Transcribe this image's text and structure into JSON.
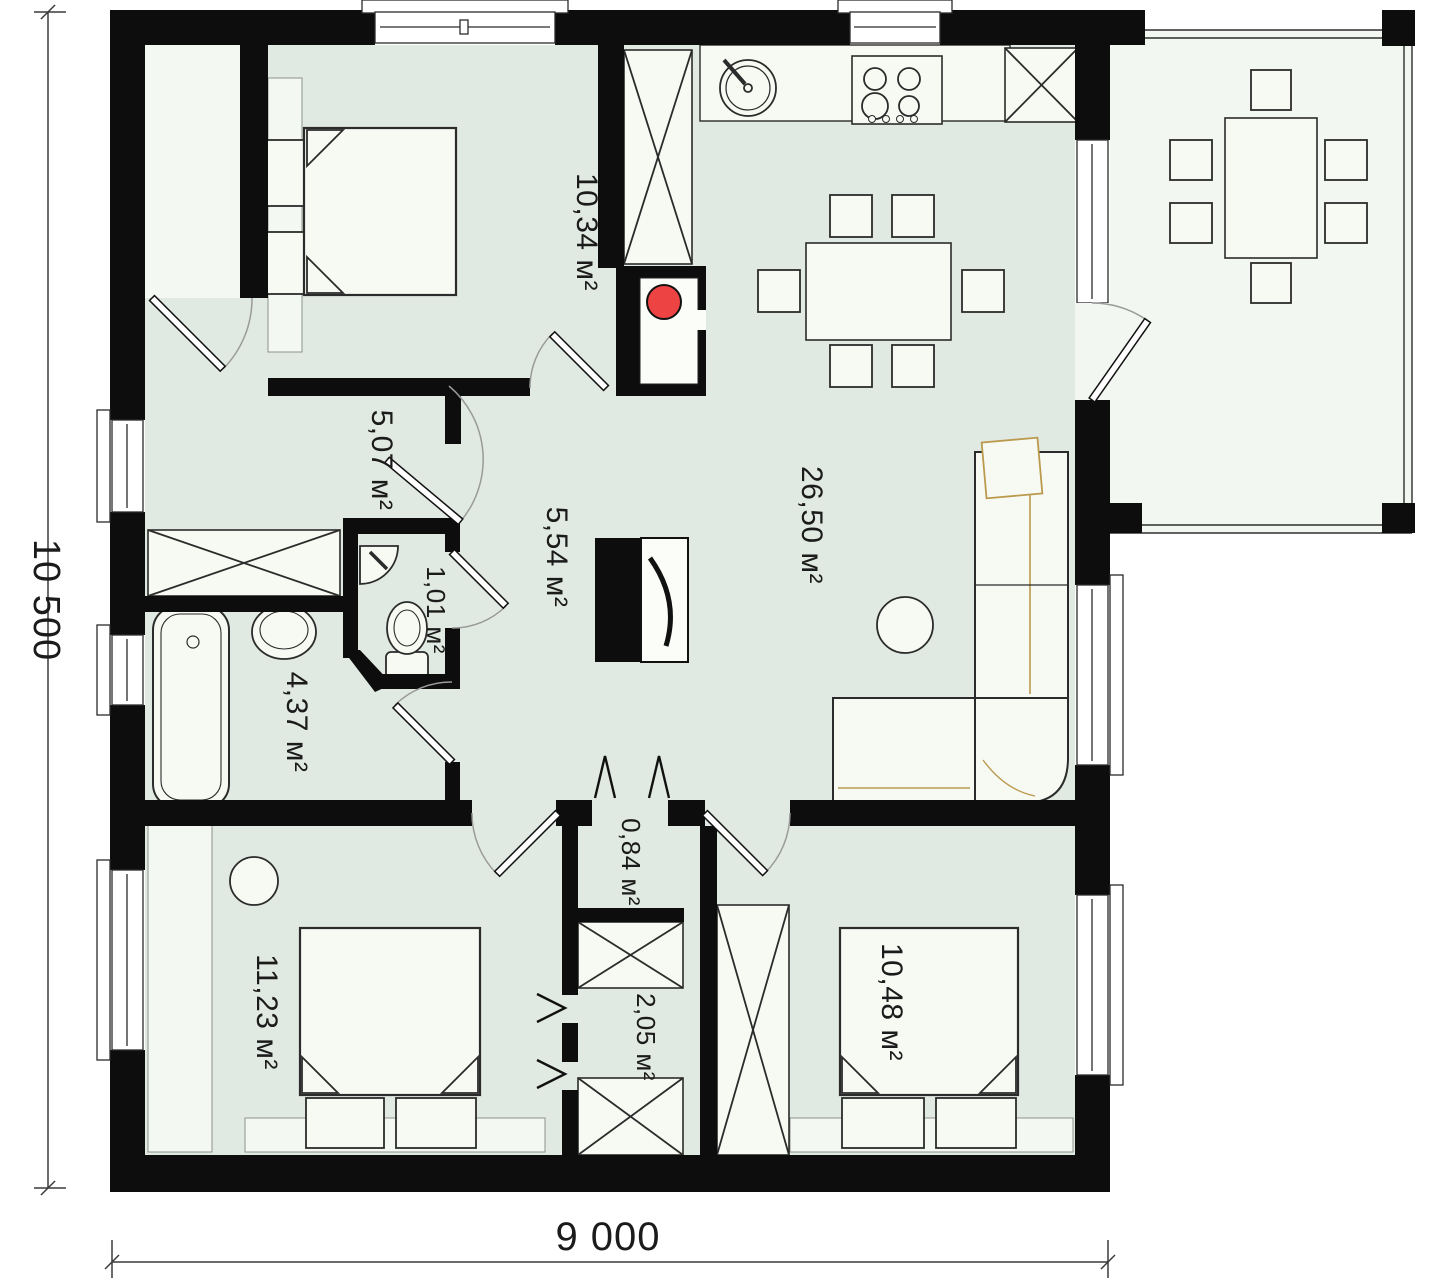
{
  "plan": {
    "title": "single-storey house floor plan",
    "rooms": [
      {
        "name": "bedroom-top-left",
        "label": "10,34 м²"
      },
      {
        "name": "hallway",
        "label": "5,07 м²"
      },
      {
        "name": "hall",
        "label": "5,54 м²"
      },
      {
        "name": "kitchen-living-room",
        "label": "26,50 м²"
      },
      {
        "name": "wc",
        "label": "1,01 м²"
      },
      {
        "name": "bathroom",
        "label": "4,37 м²"
      },
      {
        "name": "corridor",
        "label": "0,84 м²"
      },
      {
        "name": "closet",
        "label": "2,05 м²"
      },
      {
        "name": "bedroom-bottom-left",
        "label": "11,23 м²"
      },
      {
        "name": "bedroom-bottom-right",
        "label": "10,48 м²"
      }
    ],
    "dimensions": {
      "height_label": "10 500",
      "width_label": "9 000"
    },
    "colors": {
      "wall": "#0d0d0d",
      "floor": "#e1eae2",
      "light_floor": "#f4f8f2",
      "furniture_fill": "#f7faf3",
      "boiler_red": "#ee4343",
      "sofa_accent": "#bb9a50",
      "door_arc": "#9a9a9a"
    }
  }
}
